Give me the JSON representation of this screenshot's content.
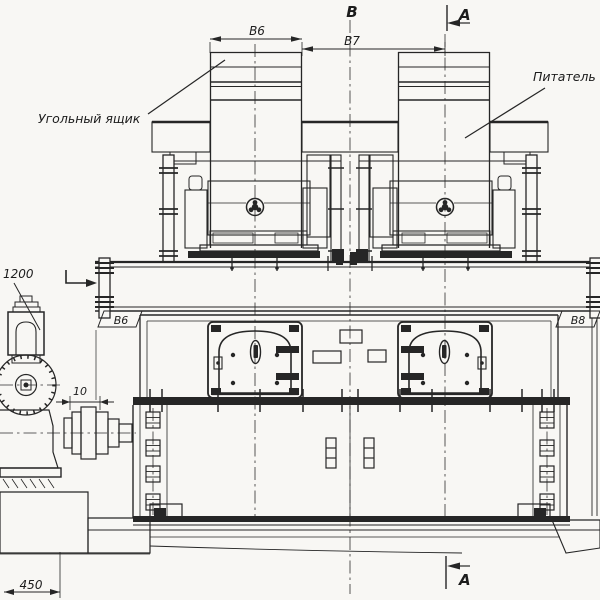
{
  "drawing": {
    "background": "#f8f7f4",
    "line_color": "#262626",
    "view_label": "В",
    "section_markers": {
      "top": "А",
      "bottom": "А"
    },
    "dimensions": {
      "b6": "В6",
      "b7": "В7",
      "elevation": "1200",
      "coupling_gap": "10",
      "foundation_depth": "450"
    },
    "flags": {
      "left": "В6",
      "right": "В8"
    },
    "callouts": {
      "coal_box": "Угольный ящик",
      "feeder": "Питатель"
    }
  }
}
